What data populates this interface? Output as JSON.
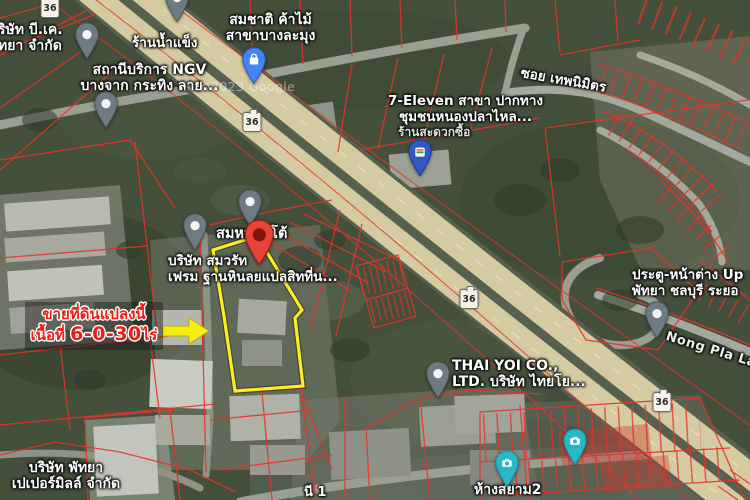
{
  "map": {
    "attribution": "©2023 Google",
    "colors": {
      "parcel_line_red": "#e8322a",
      "highlight_parcel_yellow": "#ffec1f",
      "annotation_arrow_yellow": "#f5ef0f",
      "marker_red": "#e8433a",
      "sale_text_red": "#f01d12",
      "highway_tan": "#d4cba2",
      "field_green": "#44503c"
    },
    "route_shields": [
      {
        "route": "36",
        "x": 50,
        "y": 8
      },
      {
        "route": "36",
        "x": 252,
        "y": 122
      },
      {
        "route": "36",
        "x": 469,
        "y": 299
      },
      {
        "route": "36",
        "x": 662,
        "y": 402
      }
    ],
    "labels": [
      {
        "id": "bk-company",
        "style": "poi",
        "x": -2,
        "y": 22,
        "size": 14,
        "lines": [
          "ริษัท บี.เค.",
          "ัทยา จำกัด"
        ]
      },
      {
        "id": "ice-shop",
        "style": "poi",
        "x": 132,
        "y": 36,
        "size": 13.5,
        "lines": [
          "ร้านน้ำแข็ง"
        ]
      },
      {
        "id": "ngv-station",
        "style": "poi center",
        "x": 72,
        "y": 62,
        "w": 155,
        "size": 14,
        "lines": [
          "สถานีบริการ NGV",
          "บางจาก กระทิง ลาย..."
        ]
      },
      {
        "id": "somchat-timber",
        "style": "poi center",
        "x": 218,
        "y": 12,
        "w": 105,
        "size": 14,
        "lines": [
          "สมชาติ ค้าไม้",
          "สาขาบางละมุง"
        ]
      },
      {
        "id": "seven-eleven",
        "style": "poi center",
        "x": 388,
        "y": 94,
        "w": 155,
        "size": 13.5,
        "lines": [
          "7-Eleven สาขา ปากทาง",
          "ชุมชนหนองปลาไหล..."
        ]
      },
      {
        "id": "convenience-store",
        "style": "dim",
        "x": 398,
        "y": 126,
        "size": 12,
        "lines": [
          "ร้านสะดวกซื้อ"
        ]
      },
      {
        "id": "soi-thep-nimit",
        "style": "poi",
        "x": 522,
        "y": 66,
        "size": 13.5,
        "rotate": 10,
        "lines": [
          "ซอย เทพนิมิตร"
        ]
      },
      {
        "id": "sommai-table",
        "style": "poi",
        "x": 216,
        "y": 226,
        "size": 14.5,
        "lines": [
          "สมหมายโต้"
        ]
      },
      {
        "id": "somwarat-frame",
        "style": "poi",
        "x": 168,
        "y": 254,
        "size": 13.5,
        "lines": [
          "บริษัท สมวรัท",
          "เฟรม ฐานหินลยแปลสิทที่น..."
        ]
      },
      {
        "id": "doors-windows-up",
        "style": "poi",
        "x": 632,
        "y": 268,
        "size": 13.5,
        "lines": [
          "ประตู-หน้าต่าง Up",
          "พัทยา ชลบุรี ระยอ"
        ]
      },
      {
        "id": "nong-pla-lai-road",
        "style": "road",
        "x": 668,
        "y": 330,
        "size": 13,
        "rotate": 17,
        "lines": [
          "Nong Pla Lai"
        ]
      },
      {
        "id": "thai-yoi",
        "style": "poi",
        "x": 452,
        "y": 358,
        "size": 14,
        "lines": [
          "THAI YOI CO.,",
          "LTD. บริษัท ไทยโย..."
        ]
      },
      {
        "id": "paper-mill",
        "style": "poi center",
        "x": 0,
        "y": 460,
        "w": 132,
        "size": 14,
        "lines": [
          "บริษัท พัทยา",
          "เปเปอร์มิลล์ จำกัด"
        ]
      },
      {
        "id": "siam2",
        "style": "poi",
        "x": 474,
        "y": 482,
        "size": 14,
        "lines": [
          "ห้างสยาม2"
        ]
      },
      {
        "id": "partial-label-1",
        "style": "poi",
        "x": 304,
        "y": 486,
        "size": 13,
        "lines": [
          "นี 1"
        ]
      },
      {
        "id": "google-watermark",
        "style": "watermark",
        "x": 198,
        "y": 80,
        "size": 12.5,
        "lines": [
          "©2023 Google"
        ]
      }
    ],
    "pins": [
      {
        "icon": "place-pin-icon",
        "type": "default",
        "poi": "bk-company",
        "x": 87,
        "y": 59
      },
      {
        "icon": "place-pin-icon",
        "type": "default",
        "poi": "ice-shop",
        "x": 177,
        "y": 22
      },
      {
        "icon": "place-pin-icon",
        "type": "default",
        "poi": "ngv-station",
        "x": 106,
        "y": 128
      },
      {
        "icon": "shopping-bag-pin-icon",
        "type": "shopping",
        "poi": "somchat-timber",
        "x": 254,
        "y": 84
      },
      {
        "icon": "seven-eleven-pin-icon",
        "type": "seven-eleven",
        "poi": "seven-eleven",
        "x": 420,
        "y": 176
      },
      {
        "icon": "place-pin-icon",
        "type": "default",
        "poi": "sommai-table",
        "x": 250,
        "y": 226
      },
      {
        "icon": "place-pin-icon",
        "type": "default",
        "poi": "somwarat-frame",
        "x": 195,
        "y": 250
      },
      {
        "icon": "red-marker-icon",
        "type": "red-marker",
        "poi": "highlighted-parcel",
        "x": 259,
        "y": 265,
        "size": 1.25
      },
      {
        "icon": "place-pin-icon",
        "type": "default",
        "poi": "doors-windows-up",
        "x": 657,
        "y": 338
      },
      {
        "icon": "place-pin-icon",
        "type": "default",
        "poi": "thai-yoi",
        "x": 438,
        "y": 398
      },
      {
        "icon": "camera-pin-icon",
        "type": "camera",
        "poi": "photo-spot-1",
        "x": 507,
        "y": 487
      },
      {
        "icon": "camera-pin-icon",
        "type": "camera",
        "poi": "photo-spot-2",
        "x": 575,
        "y": 465
      }
    ]
  },
  "annotation": {
    "line1": "ขายที่ดินแปลงนี้",
    "line2_prefix": "เนื้อที่ ",
    "area": "6-0-30",
    "unit": "ไร่"
  }
}
